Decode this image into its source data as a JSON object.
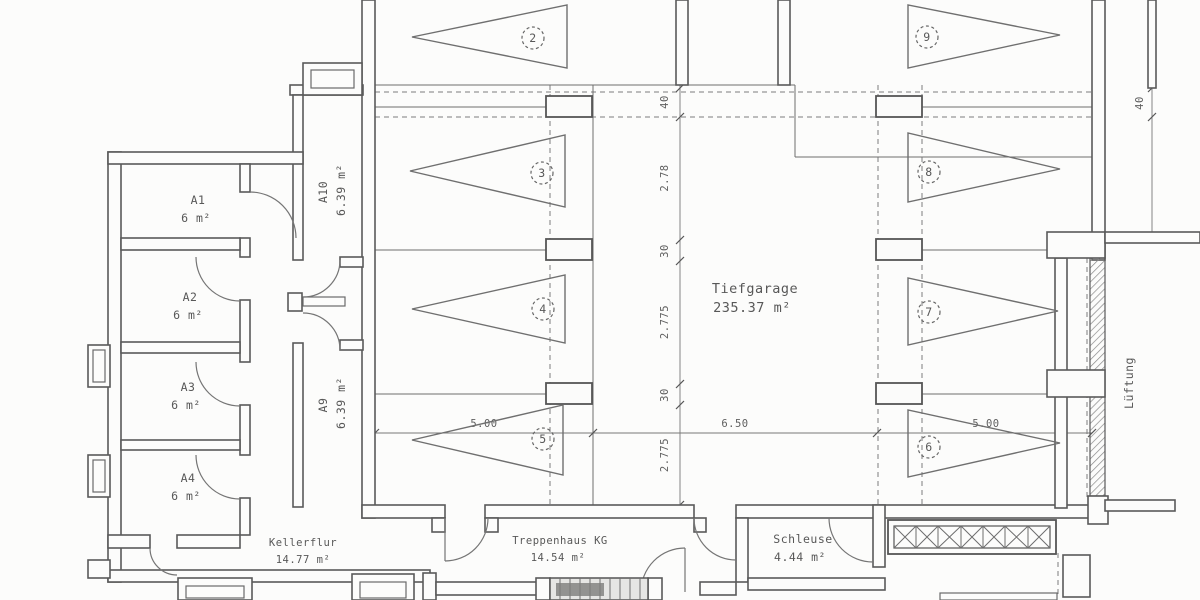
{
  "title": "Kellergeschoss Grundriss (basement floor plan)",
  "rooms": {
    "tiefgarage": {
      "name": "Tiefgarage",
      "area": "235.37 m²"
    },
    "a1": {
      "id": "A1",
      "area": "6 m²"
    },
    "a2": {
      "id": "A2",
      "area": "6 m²"
    },
    "a3": {
      "id": "A3",
      "area": "6 m²"
    },
    "a4": {
      "id": "A4",
      "area": "6 m²"
    },
    "a10": {
      "id": "A10",
      "area": "6.39 m²"
    },
    "a9": {
      "id": "A9",
      "area": "6.39 m²"
    },
    "kellerflur": {
      "name": "Kellerflur",
      "area": "14.77 m²"
    },
    "treppenhaus": {
      "name": "Treppenhaus KG",
      "area": "14.54 m²"
    },
    "schleuse": {
      "name": "Schleuse",
      "area": "4.44 m²"
    }
  },
  "labels": {
    "ventilation": "Lüftung"
  },
  "parking": {
    "p2": "2",
    "p3": "3",
    "p4": "4",
    "p5": "5",
    "p6": "6",
    "p7": "7",
    "p8": "8",
    "p9": "9"
  },
  "dimensions": {
    "v40": "40",
    "v278": "2.78",
    "v30a": "30",
    "v2775a": "2.775",
    "v30b": "30",
    "v2775b": "2.775",
    "h500a": "5.00",
    "h650": "6.50",
    "h500b": "5.00",
    "tr40": "40"
  }
}
